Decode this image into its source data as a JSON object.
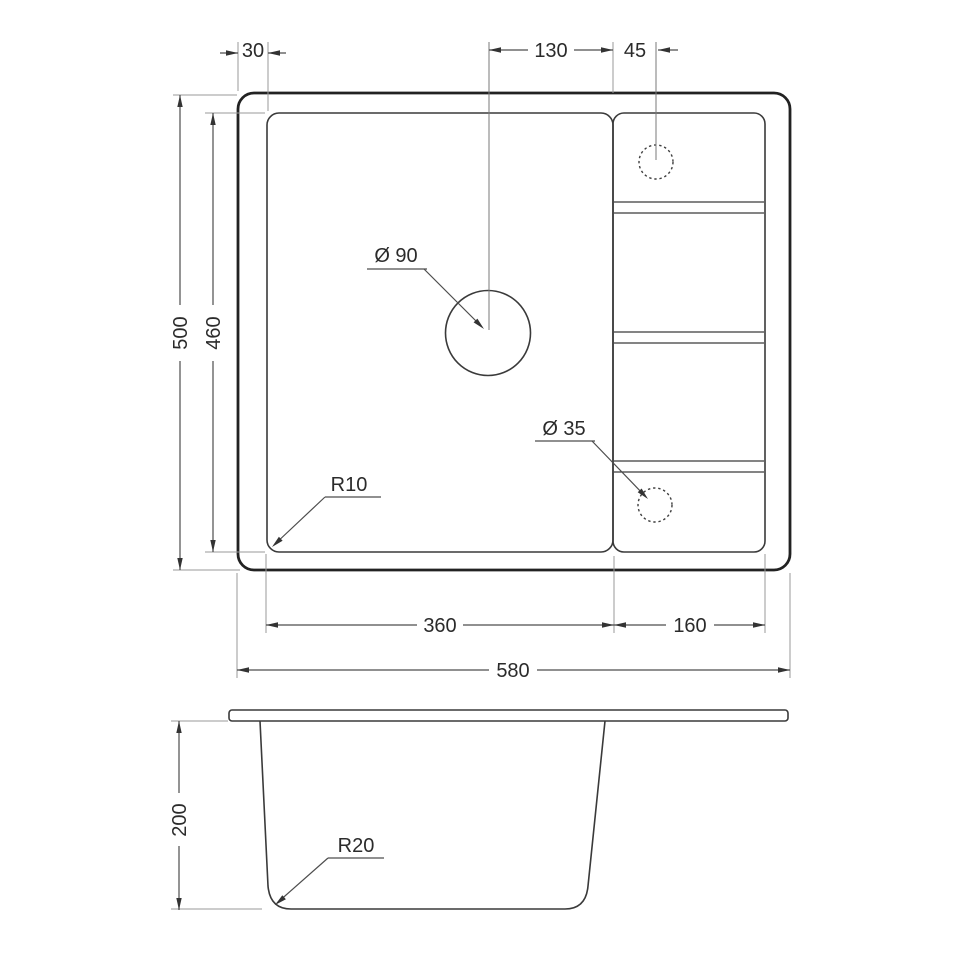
{
  "drawing": {
    "top_view": {
      "inset_left": "30",
      "tap_hole_span": "130",
      "tap_hole_offset": "45",
      "outer_height": "500",
      "bowl_height": "460",
      "drain_diameter": "Ø 90",
      "tap_hole_diameter": "Ø 35",
      "bowl_corner_radius": "R10",
      "bowl_width": "360",
      "drainboard_width": "160",
      "outer_width": "580"
    },
    "side_view": {
      "depth": "200",
      "bottom_corner_radius": "R20"
    }
  }
}
